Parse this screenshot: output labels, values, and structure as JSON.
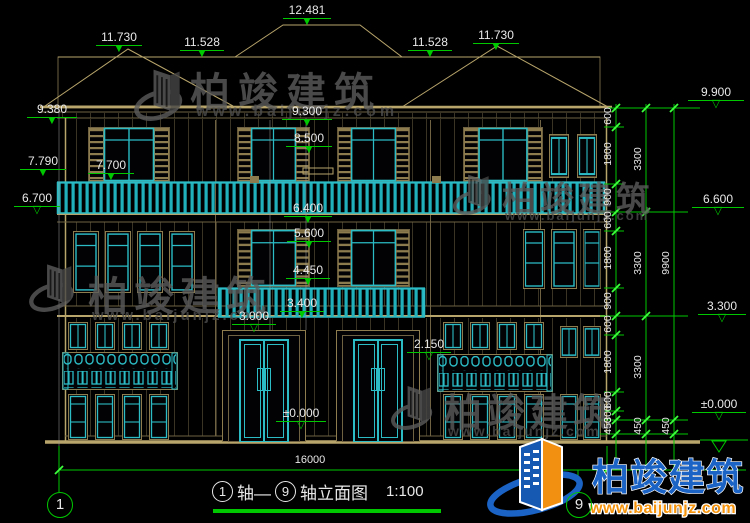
{
  "colors": {
    "background": "#000000",
    "line_tan": "#b8a56b",
    "line_teal": "#2bbcc6",
    "dimension_green": "#00c800",
    "text_white": "#e8e8e8",
    "watermark_gray": "#5c5c5c",
    "logo_blue": "#1b63c4",
    "logo_orange": "#f29111"
  },
  "elevations": {
    "top": [
      {
        "v": "11.730"
      },
      {
        "v": "11.528"
      },
      {
        "v": "12.481"
      },
      {
        "v": "11.528"
      },
      {
        "v": "11.730"
      }
    ],
    "left": [
      {
        "v": "9.380"
      },
      {
        "v": "7.790"
      },
      {
        "v": "7.700"
      },
      {
        "v": "6.700"
      }
    ],
    "center": [
      {
        "v": "9.300"
      },
      {
        "v": "8.500"
      },
      {
        "v": "6.400"
      },
      {
        "v": "5.600"
      },
      {
        "v": "4.450"
      },
      {
        "v": "3.400"
      },
      {
        "v": "3.000"
      },
      {
        "v": "2.150"
      },
      {
        "v": "±0.000"
      }
    ],
    "right": [
      {
        "v": "9.900"
      },
      {
        "v": "6.600"
      },
      {
        "v": "3.300"
      },
      {
        "v": "±0.000"
      }
    ]
  },
  "dimensions": {
    "right_chain_inner": [
      "600",
      "1800",
      "900",
      "600",
      "1800",
      "900",
      "600",
      "1800",
      "600",
      "300",
      "450"
    ],
    "right_chain_mid": [
      "3300",
      "3300",
      "3300",
      "450"
    ],
    "right_chain_outer": [
      "9900",
      "450"
    ],
    "bottom_total": "16000"
  },
  "axes": {
    "left_bubble": "1",
    "right_bubble": "9"
  },
  "title": {
    "axis_start": "1",
    "axis_word_1": "轴—",
    "axis_end": "9",
    "axis_word_2": "轴立面图",
    "scale": "1:100"
  },
  "watermark": {
    "name": "柏竣建筑",
    "url": "www.baijunjz.com"
  },
  "logo": {
    "name": "柏竣建筑",
    "url": "www.baijunjz.com"
  }
}
